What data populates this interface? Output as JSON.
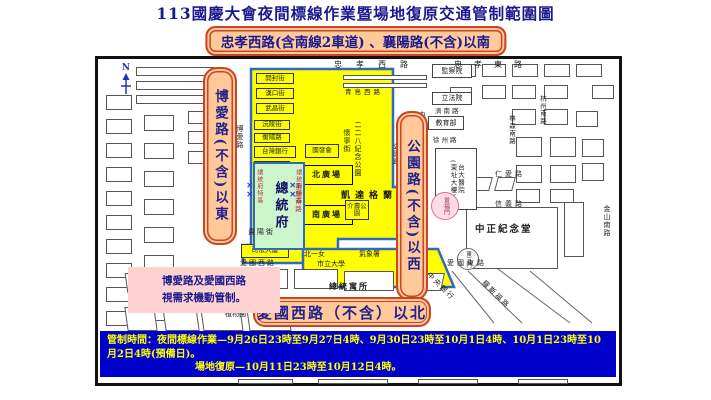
{
  "title": "113國慶大會夜間標線作業暨場地復原交通管制範圍圖",
  "subtitle": "忠孝西路(含南線2車道) 、襄陽路(不含)以南",
  "north_label": "N",
  "zone_labels": {
    "east": "博愛路(不含)以東",
    "west": "公園路(不含)以西",
    "north": "愛國西路（不含）以北"
  },
  "note": "博愛路及愛國西路\n視需求機動管制。",
  "control_times": {
    "line1": "管制時間：夜間標線作業—9月26日23時至9月27日4時、9月30日23時至10月1日4時、10月1日23時至10月2日4時(預備日)。",
    "line2": "場地復原—10月11日23時至10月12日4時。"
  },
  "colors": {
    "banner_bg": "#0000cc",
    "banner_text": "#ffff00",
    "zone_fill": "#ffff00",
    "zone_border": "#3168c8",
    "label_bg": "#ffc999",
    "label_border": "#cc4422",
    "title_text": "#1a1a8e"
  },
  "map": {
    "labels": [
      {
        "t": "開封街",
        "x": 158,
        "y": 14,
        "w": 38,
        "h": 11,
        "c": "yb",
        "fs": 6.5
      },
      {
        "t": "漢口街",
        "x": 158,
        "y": 29,
        "w": 38,
        "h": 11,
        "c": "yb",
        "fs": 6.5
      },
      {
        "t": "武昌街",
        "x": 158,
        "y": 44,
        "w": 38,
        "h": 11,
        "c": "yb",
        "fs": 6.5
      },
      {
        "t": "沅陵街",
        "x": 156,
        "y": 61,
        "w": 36,
        "h": 10,
        "c": "yb",
        "fs": 6.5
      },
      {
        "t": "衡陽路",
        "x": 156,
        "y": 74,
        "w": 36,
        "h": 10,
        "c": "yb",
        "fs": 6.5
      },
      {
        "t": "台灣銀行",
        "x": 156,
        "y": 87,
        "w": 42,
        "h": 12,
        "c": "yb",
        "fs": 6.5
      },
      {
        "t": "寶慶路",
        "x": 156,
        "y": 102,
        "w": 36,
        "h": 10,
        "c": "yb",
        "fs": 6.5
      },
      {
        "t": "國發會",
        "x": 207,
        "y": 85,
        "w": 34,
        "h": 14,
        "c": "yb",
        "fs": 6.5
      },
      {
        "t": "北廣場",
        "x": 203,
        "y": 106,
        "w": 52,
        "h": 20,
        "c": "plaza",
        "fs": 8
      },
      {
        "t": "南廣場",
        "x": 203,
        "y": 146,
        "w": 52,
        "h": 20,
        "c": "plaza",
        "fs": 8
      },
      {
        "t": "介壽公園",
        "x": 247,
        "y": 141,
        "w": 24,
        "h": 20,
        "c": "yb",
        "fs": 6.5
      },
      {
        "t": "司法大廈",
        "x": 143,
        "y": 185,
        "w": 48,
        "h": 14,
        "c": "yb",
        "fs": 6.8
      },
      {
        "t": "監察院",
        "x": 334,
        "y": 5,
        "w": 40,
        "h": 14,
        "c": "wb",
        "fs": 7
      },
      {
        "t": "立法院",
        "x": 334,
        "y": 33,
        "w": 40,
        "h": 13,
        "c": "wb",
        "fs": 7
      },
      {
        "t": "教育部",
        "x": 330,
        "y": 57,
        "w": 36,
        "h": 14,
        "c": "wb",
        "fs": 7
      },
      {
        "t": "台大醫院\n(東址大樓)",
        "x": 337,
        "y": 89,
        "w": 42,
        "h": 62,
        "c": "wbv",
        "fs": 6.5
      },
      {
        "t": "博愛\n大樓",
        "x": 107,
        "y": 110,
        "w": 26,
        "h": 26,
        "c": "wb",
        "fs": 6.5
      },
      {
        "t": "國史館",
        "x": 113,
        "y": 140,
        "w": 22,
        "h": 38,
        "c": "wbv",
        "fs": 7
      },
      {
        "t": "總統府",
        "x": 155,
        "y": 103,
        "w": 52,
        "h": 88,
        "c": "gov",
        "fs": 13
      },
      {
        "t": "景福門",
        "x": 333,
        "y": 133,
        "w": 28,
        "h": 28,
        "c": "circ pink",
        "fs": 6
      },
      {
        "t": "東三門",
        "x": 359,
        "y": 189,
        "w": 22,
        "h": 22,
        "c": "circ",
        "fs": 5.5
      },
      {
        "t": "忠孝西路",
        "x": 236,
        "y": 1,
        "c": "st",
        "fs": 8,
        "ls": 14
      },
      {
        "t": "忠孝東路",
        "x": 356,
        "y": 1,
        "c": "st",
        "fs": 8,
        "ls": 12
      },
      {
        "t": "青島西路",
        "x": 247,
        "y": 30,
        "c": "st",
        "fs": 6.5,
        "ls": 3
      },
      {
        "t": "濟南路",
        "x": 337,
        "y": 49,
        "c": "st",
        "fs": 6.5,
        "ls": 2
      },
      {
        "t": "徐州路",
        "x": 335,
        "y": 78,
        "c": "st",
        "fs": 6.5,
        "ls": 2
      },
      {
        "t": "凱達格蘭大道",
        "x": 243,
        "y": 132,
        "c": "st bold",
        "fs": 9,
        "ls": 5
      },
      {
        "t": "仁愛路",
        "x": 397,
        "y": 111,
        "c": "st",
        "fs": 7,
        "ls": 3
      },
      {
        "t": "信義路",
        "x": 397,
        "y": 141,
        "c": "st",
        "fs": 7,
        "ls": 3
      },
      {
        "t": "愛國東路",
        "x": 349,
        "y": 200,
        "c": "st",
        "fs": 7,
        "ls": 3
      },
      {
        "t": "愛國西路",
        "x": 142,
        "y": 200,
        "c": "st",
        "fs": 7,
        "ls": 2
      },
      {
        "t": "總統寓所",
        "x": 231,
        "y": 223,
        "c": "st bold",
        "fs": 8,
        "ls": 2
      },
      {
        "t": "植物園",
        "x": 127,
        "y": 251,
        "c": "st",
        "fs": 7
      },
      {
        "t": "中正紀念堂",
        "x": 377,
        "y": 166,
        "c": "st bold",
        "fs": 9.5,
        "ls": 2
      },
      {
        "t": "北一女",
        "x": 206,
        "y": 191,
        "c": "st",
        "fs": 7
      },
      {
        "t": "氣象署",
        "x": 261,
        "y": 191,
        "c": "st",
        "fs": 7
      },
      {
        "t": "市立大學",
        "x": 219,
        "y": 201,
        "c": "st",
        "fs": 7
      },
      {
        "t": "貴陽街",
        "x": 150,
        "y": 169,
        "c": "st",
        "fs": 7,
        "ls": 2
      },
      {
        "t": "博愛路",
        "x": 138,
        "y": 66,
        "c": "stv",
        "fs": 7
      },
      {
        "t": "懷寧街",
        "x": 245,
        "y": 70,
        "c": "stv",
        "fs": 7
      },
      {
        "t": "二二八紀念公園",
        "x": 256,
        "y": 62,
        "h": 118,
        "c": "stv",
        "fs": 7
      },
      {
        "t": "公園路",
        "x": 293,
        "y": 84,
        "c": "stv",
        "fs": 6.5
      },
      {
        "t": "中山南路",
        "x": 320,
        "y": 52,
        "c": "stv",
        "fs": 7
      },
      {
        "t": "林森南路",
        "x": 409,
        "y": 56,
        "c": "stv",
        "fs": 6.5
      },
      {
        "t": "杭州南路",
        "x": 440,
        "y": 36,
        "c": "stv",
        "fs": 6.5
      },
      {
        "t": "金山南路",
        "x": 505,
        "y": 146,
        "c": "stv",
        "fs": 7
      },
      {
        "t": "重慶南路",
        "x": 195,
        "y": 124,
        "c": "stv red",
        "fs": 6.5
      },
      {
        "t": "總統府特區",
        "x": 157,
        "y": 110,
        "c": "stv red",
        "fs": 6
      },
      {
        "t": "總統府特區",
        "x": 196,
        "y": 110,
        "c": "stv red",
        "fs": 6
      },
      {
        "t": "✕✕",
        "x": 147,
        "y": 122,
        "c": "stv xb",
        "fs": 8
      },
      {
        "t": "✕✕",
        "x": 190,
        "y": 122,
        "c": "stv xb",
        "fs": 8
      },
      {
        "t": "中央銀行",
        "x": 333,
        "y": 212,
        "c": "st rot",
        "fs": 7,
        "ls": 2
      },
      {
        "t": "羅斯福路",
        "x": 388,
        "y": 220,
        "c": "st rot",
        "fs": 7,
        "ls": 2
      }
    ],
    "blocks": [
      [
        38,
        8,
        78,
        9
      ],
      [
        38,
        22,
        78,
        9
      ],
      [
        38,
        36,
        78,
        9
      ],
      [
        8,
        36,
        26,
        15
      ],
      [
        8,
        60,
        26,
        15
      ],
      [
        8,
        84,
        26,
        15
      ],
      [
        8,
        108,
        26,
        15
      ],
      [
        8,
        132,
        26,
        15
      ],
      [
        8,
        156,
        26,
        15
      ],
      [
        8,
        180,
        26,
        15
      ],
      [
        8,
        204,
        26,
        15
      ],
      [
        8,
        228,
        26,
        15
      ],
      [
        8,
        252,
        26,
        15
      ],
      [
        8,
        280,
        26,
        14
      ],
      [
        46,
        56,
        30,
        16
      ],
      [
        46,
        84,
        30,
        16
      ],
      [
        46,
        112,
        30,
        16
      ],
      [
        46,
        140,
        30,
        16
      ],
      [
        46,
        168,
        30,
        16
      ],
      [
        46,
        196,
        30,
        16
      ],
      [
        46,
        246,
        30,
        16
      ],
      [
        90,
        52,
        26,
        13
      ],
      [
        90,
        72,
        26,
        13
      ],
      [
        90,
        92,
        26,
        13
      ],
      [
        245,
        16,
        84,
        5
      ],
      [
        245,
        24,
        84,
        5
      ],
      [
        350,
        5,
        28,
        13
      ],
      [
        384,
        5,
        24,
        13
      ],
      [
        414,
        5,
        26,
        13
      ],
      [
        446,
        5,
        26,
        13
      ],
      [
        478,
        5,
        26,
        13
      ],
      [
        494,
        26,
        22,
        14
      ],
      [
        352,
        28,
        22,
        12
      ],
      [
        384,
        26,
        24,
        14
      ],
      [
        414,
        26,
        24,
        14
      ],
      [
        446,
        26,
        24,
        14
      ],
      [
        414,
        50,
        24,
        16
      ],
      [
        446,
        50,
        24,
        16
      ],
      [
        478,
        52,
        22,
        16
      ],
      [
        418,
        78,
        26,
        20
      ],
      [
        452,
        78,
        26,
        20
      ],
      [
        484,
        80,
        22,
        18
      ],
      [
        418,
        106,
        26,
        18
      ],
      [
        452,
        106,
        26,
        18
      ],
      [
        484,
        104,
        22,
        18
      ],
      [
        375,
        118,
        18,
        14,
        -15
      ],
      [
        398,
        118,
        18,
        14,
        -15
      ],
      [
        418,
        130,
        24,
        14
      ],
      [
        452,
        130,
        24,
        14
      ],
      [
        368,
        148,
        92,
        62
      ],
      [
        466,
        143,
        20,
        55
      ],
      [
        28,
        214,
        32,
        20,
        8
      ],
      [
        68,
        214,
        38,
        20,
        8
      ],
      [
        28,
        248,
        30,
        24,
        8
      ],
      [
        66,
        248,
        34,
        24,
        8
      ],
      [
        104,
        250,
        40,
        22,
        8
      ],
      [
        150,
        250,
        42,
        22,
        8
      ],
      [
        12,
        300,
        26,
        14
      ],
      [
        46,
        298,
        32,
        16
      ],
      [
        84,
        298,
        36,
        16
      ],
      [
        150,
        210,
        40,
        20
      ],
      [
        196,
        210,
        44,
        20
      ],
      [
        246,
        212,
        50,
        20
      ],
      [
        305,
        214,
        40,
        18,
        -12
      ],
      [
        140,
        320,
        55,
        5
      ],
      [
        220,
        320,
        70,
        5
      ],
      [
        320,
        320,
        60,
        5
      ],
      [
        420,
        320,
        50,
        5
      ]
    ]
  }
}
